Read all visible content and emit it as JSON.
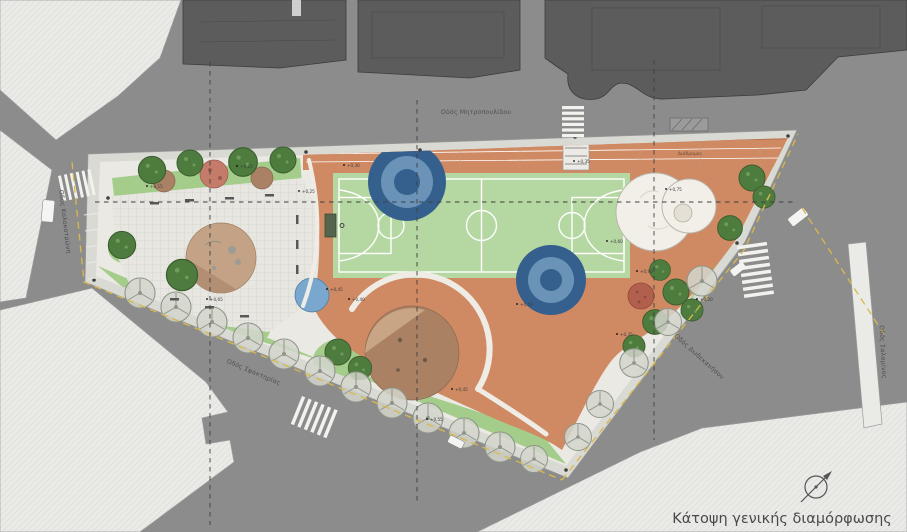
{
  "meta": {
    "drawing_type": "architectural site plan"
  },
  "palette": {
    "street": "#8c8c8c",
    "building_dark": "#5c5c5c",
    "building_dark_edge": "#3c3c3c",
    "building_light": "#eaeae7",
    "building_light_edge": "#9b9b9b",
    "sidewalk": "#dadad4",
    "park_base": "#eae9e3",
    "plaza": "#e7e6e0",
    "sport_orange": "#cf8a63",
    "court_green": "#b5d7a1",
    "lawn": "#a4cc8a",
    "tree_dark": "#4e7c3e",
    "sand_tan": "#c3a286",
    "play_brown": "#ab8164",
    "canopy_blue_dark": "#35608d",
    "canopy_blue_mid": "#6b93b8",
    "water_blue": "#7aa7cd",
    "circle_white": "#f2efe9",
    "red_circle": "#b35f4e",
    "curb_yellow": "#d9b94a",
    "grid_dash": "#3f3f3f",
    "text_dark": "#4a4a4a"
  },
  "labels": {
    "caption": "Κάτοψη γενικής διαμόρφωσης",
    "street_top": "Οδός Μητροπουλίδου",
    "street_left": "Οδός Κολοκοτρώνη",
    "street_bottom_left": "Οδός Σφακτηρίας",
    "street_right": "Οδός Δωδεκανήσου",
    "street_far_right": "Οδός Σαλαμίνος",
    "track": "Διάδρομος"
  },
  "spots": [
    "+0,15",
    "+0,20",
    "+0,25",
    "+0,30",
    "+0,35",
    "+0,40",
    "+0,45",
    "+0,50",
    "+0,60",
    "+0,75",
    "+0,90",
    "+0,20",
    "+0,35",
    "+0,45",
    "+0,55",
    "+0,65"
  ]
}
